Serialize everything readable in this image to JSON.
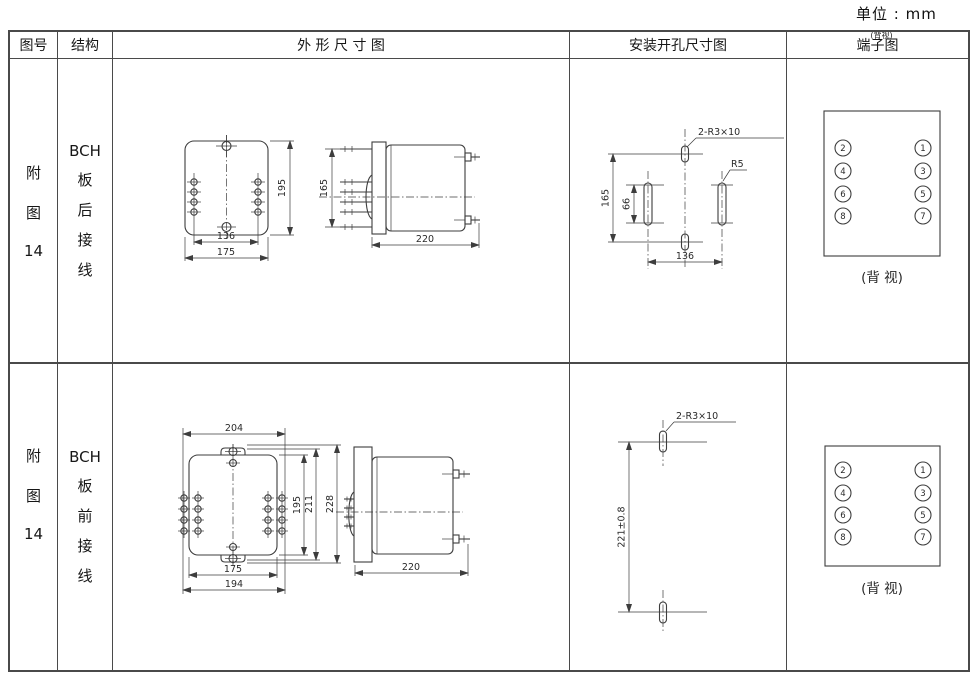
{
  "page": {
    "unit_label": "单位 : mm"
  },
  "header": {
    "col_figure": "图号",
    "col_structure": "结构",
    "col_outline": "外 形 尺 寸 图",
    "col_install": "安装开孔尺寸图",
    "col_terminal": "端子图",
    "col_terminal_super": "(背视)"
  },
  "rows": [
    {
      "figure_no": [
        "附",
        "图",
        "14"
      ],
      "structure": [
        "BCH",
        "板",
        "后",
        "接",
        "线"
      ],
      "outline": {
        "front_height": "195",
        "side_height": "165",
        "pin_span": "136",
        "body_width": "175",
        "depth": "220"
      },
      "install": {
        "slot_note": "2-R3×10",
        "radius_note": "R5",
        "hole_height": "165",
        "slot_height": "66",
        "hole_span": "136"
      },
      "terminals": {
        "left": [
          "2",
          "4",
          "6",
          "8"
        ],
        "right": [
          "1",
          "3",
          "5",
          "7"
        ],
        "caption": "(背 视)"
      }
    },
    {
      "figure_no": [
        "附",
        "图",
        "14"
      ],
      "structure": [
        "BCH",
        "板",
        "前",
        "接",
        "线"
      ],
      "outline": {
        "top_width": "204",
        "front_height": "195",
        "mid_height": "211",
        "overall_height": "228",
        "body_width": "175",
        "overall_width": "194",
        "depth": "220"
      },
      "install": {
        "slot_note": "2-R3×10",
        "hole_height": "221±0.8"
      },
      "terminals": {
        "left": [
          "2",
          "4",
          "6",
          "8"
        ],
        "right": [
          "1",
          "3",
          "5",
          "7"
        ],
        "caption": "(背 视)"
      }
    }
  ]
}
